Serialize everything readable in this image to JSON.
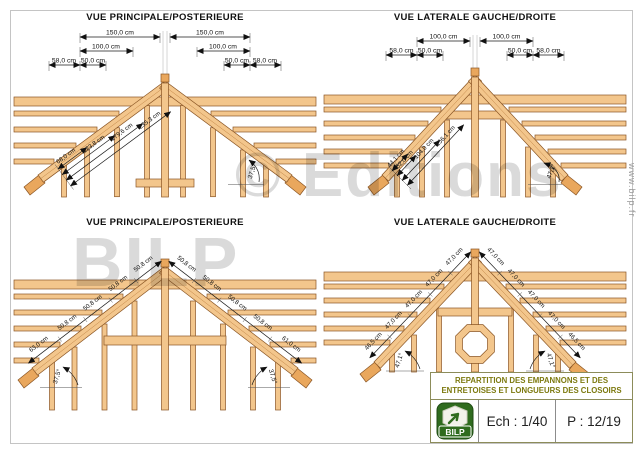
{
  "sheet": {
    "watermark_line1": "© Editions",
    "watermark_line2": "BILP",
    "side_url": "www.bilp.fr"
  },
  "panels": {
    "tl": {
      "title": "VUE PRINCIPALE/POSTERIEURE",
      "top_dims": {
        "row1": [
          "150,0 cm",
          "150,0 cm"
        ],
        "row2": [
          "100,0 cm",
          "100,0 cm"
        ],
        "row3": [
          "58,0 cm",
          "50,0 cm",
          "50,0 cm",
          "58,0 cm"
        ]
      },
      "diag": [
        "68,0 cm",
        "123,8 cm",
        "179,6 cm",
        "235,3 cm"
      ],
      "angle": "37,5°"
    },
    "tr": {
      "title": "VUE LATERALE GAUCHE/DROITE",
      "top_dims": {
        "row1": [
          "100,0 cm",
          "100,0 cm"
        ],
        "row2": [
          "58,0 cm",
          "50,0 cm",
          "50,0 cm",
          "58,0 cm"
        ]
      },
      "diag": [
        "44,1 cm",
        "52,0 cm",
        "104,0 cm",
        "156,1 cm"
      ],
      "angle": "47,1°"
    },
    "bl": {
      "title": "VUE PRINCIPALE/POSTERIEURE",
      "left_segments": [
        "63,0 cm",
        "50,8 cm",
        "50,8 cm",
        "50,8 cm",
        "50,8 cm"
      ],
      "right_segments": [
        "50,8 cm",
        "50,8 cm",
        "50,8 cm",
        "50,8 cm",
        "61,0 cm"
      ],
      "angle_left": "37,5°",
      "angle_right": "37,5°"
    },
    "br": {
      "title": "VUE LATERALE GAUCHE/DROITE",
      "left_segments": [
        "46,5 cm",
        "47,0 cm",
        "47,0 cm",
        "47,0 cm",
        "47,0 cm"
      ],
      "right_segments": [
        "47,0 cm",
        "47,0 cm",
        "47,0 cm",
        "47,0 cm",
        "46,5 cm"
      ],
      "angle_left": "47,1°",
      "angle_right": "47,1°"
    }
  },
  "title_block": {
    "header_line1": "REPARTITION DES EMPANNONS ET DES",
    "header_line2": "ENTRETOISES ET LONGUEURS DES CLOSOIRS",
    "logo_text": "BILP",
    "scale_label": "Ech : 1/40",
    "page_label": "P : 12/19"
  },
  "colors": {
    "wood": "#F3C68C",
    "wood_dark": "#E9A75D",
    "wood_outline": "#8A5524",
    "title_block_text": "#7D7A10",
    "logo_green": "#2F6B1E",
    "watermark_gray": "#C9C9C9"
  }
}
